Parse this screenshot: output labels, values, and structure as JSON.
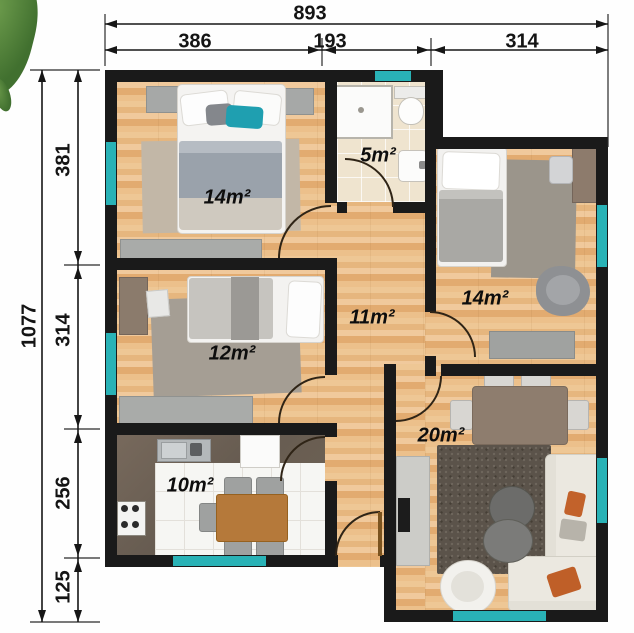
{
  "plan_title": "apartment-floor-plan",
  "dimensions": {
    "top": {
      "total": "893",
      "segments": [
        "386",
        "193",
        "314"
      ]
    },
    "left": {
      "total": "1077",
      "segments": [
        "381",
        "314",
        "256",
        "125"
      ]
    }
  },
  "rooms": {
    "bedroom_top_left": {
      "area": "14m²"
    },
    "bathroom": {
      "area": "5m²"
    },
    "bedroom_right": {
      "area": "14m²"
    },
    "hallway": {
      "area": "11m²"
    },
    "bedroom_small": {
      "area": "12m²"
    },
    "kitchen": {
      "area": "10m²"
    },
    "living_room": {
      "area": "20m²"
    }
  },
  "colors": {
    "wall": "#1a1a1a",
    "window_teal": "#29b2b6",
    "wood_floor": "#e9b97f",
    "bath_tile": "#efe4cf",
    "kitchen_tile": "#f6f6f3",
    "kitchen_counter": "#6f6355",
    "rug_gray": "#a59e94",
    "living_rug": "#5b534a",
    "sofa_cream": "#ebe8e0",
    "accent_orange": "#c2622b",
    "accent_teal_pillow": "#1f9fb0",
    "table_wood": "#b5793a",
    "dining_table_taupe": "#8e7d6e"
  }
}
